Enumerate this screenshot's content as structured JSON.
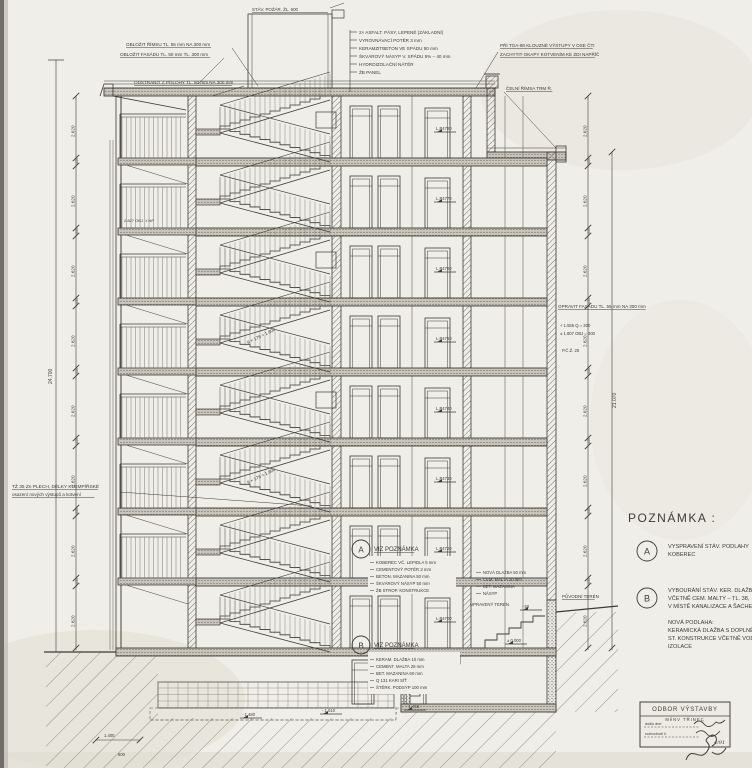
{
  "drawing_title": "ŘEZ OBJEKTEM",
  "notes_panel": {
    "title": "POZNÁMKA :",
    "a": {
      "label": "A",
      "lines": [
        "VYSPRAVENÍ STÁV. PODLAHY",
        "KOBEREC"
      ]
    },
    "b": {
      "label": "B",
      "lines": [
        "VYBOURÁNÍ STÁV. KER. DLAŽBY",
        "VČETNĚ CEM. MALTY – TL. 38,",
        "V MÍSTĚ KANALIZACE A ŠACHET – TL. 98"
      ]
    },
    "extra": [
      "NOVÁ PODLAHA:",
      "KERAMICKÁ DLAŽBA S DOPLNĚNÍM",
      "ST. KONSTRUKCE VČETNĚ VODOTĚSNÉ",
      "IZOLACE"
    ]
  },
  "callouts": {
    "a": "VIZ POZNÁMKA",
    "b": "VIZ POZNÁMKA",
    "a_letter": "A",
    "b_letter": "B"
  },
  "spec_a": [
    "KOBEREC VČ. LEPIDLA  5 mm",
    "CEMENTOVÝ POTĚR  2 mm",
    "BETON. MAZANINA  50 mm",
    "ŠKVÁROVÝ NÁSYP  50 mm",
    "ŽB STROP. KONSTRUKCE"
  ],
  "spec_b": [
    "KERAM. DLAŽBA  10 mm",
    "CEMENT. MALTA  28 mm",
    "BET. MAZANINA  60 mm",
    "Q 131 KARI SÍŤ",
    "ŠTĚRK. PODSYP  100 mm"
  ],
  "roof_spec": [
    "2× ASFALT. PÁSY, LEPENÉ (ZÁKLADNÍ)",
    "VYROVNÁVACÍ POTĚR  3 mm",
    "KERAMZITBETON VE SPÁDU  50 mm",
    "ŠKVÁROVÝ NÁSYP V. SPÁDU 5% – 40 mm",
    "HYDROIZOLAČNÍ NÁTĚR",
    "ŽB PANEL"
  ],
  "top_left_notes": [
    "OBLOŽIT ŘÍMSU TL. 55 mm NA 300 mm",
    "OBLOŽIT FASÁDU TL. 50 mm TL. 300 mm",
    "ODSTRANIT Z POLOHY TL. 50 mm NA 300 mm"
  ],
  "top_right_notes": [
    "PŘI TGA-88 KLOUZNÉ VÝSTUPY V OSE ČTI",
    "ZACHYTIT OKAPY KOTVENÍM KE ZDI NAPŘÍČ"
  ],
  "cornice_note": "ČELNÍ ŘÍMSA TRM Ř.",
  "chimney_label": "STÁV. POŽÁR. ŽL. 600",
  "left_note": [
    "TŽ 35 Zn PLECH, DÉLKY KLEMPÍŘSKÉ",
    "osazení nových výstupů a kotvení"
  ],
  "right_wall_note": "OPRAVIT FASÁDU TL. 55 mm NA 300 mm",
  "right_levels": [
    "+ 1.555  Q = 300",
    "± 1.807  OBJ = 300",
    "P.Č.Ž. 25"
  ],
  "terrain": {
    "original": "PŮVODNÍ TERÉN",
    "adjusted": "UPRAVENÝ TERÉN"
  },
  "exterior_spec": [
    "NOVÁ DLAŽBA  50 mm",
    "CEM. MALTA  20 mm",
    "BET. MAZANINA",
    "NÁSYP"
  ],
  "gallery_note": "2.827 OBJ. ± NP",
  "flight_note": "9 × 178 = 1.600",
  "level_codes": [
    "L.P4780",
    "L.P4770",
    "L.P4760",
    "L.P4750",
    "L.P4740",
    "L.P4730",
    "L.P4720",
    "L.P4700"
  ],
  "dims": {
    "storey": "2.620",
    "slab": "450",
    "total_left": "24.700",
    "total_right": "21.070",
    "bottom": "1.400",
    "bottom2": "600",
    "marks": {
      "m1": "- 1.480",
      "m2": "- 1.010",
      "m3": "- 1.456",
      "m4": "± 0.000",
      "m5": "- 50"
    }
  },
  "stamp": {
    "line1": "ODBOR VÝSTAVBY",
    "line2": "MěNV TŘINEC",
    "line3": "došlo dne",
    "line4": "rozhodnutí č.",
    "line5": "4/91"
  }
}
